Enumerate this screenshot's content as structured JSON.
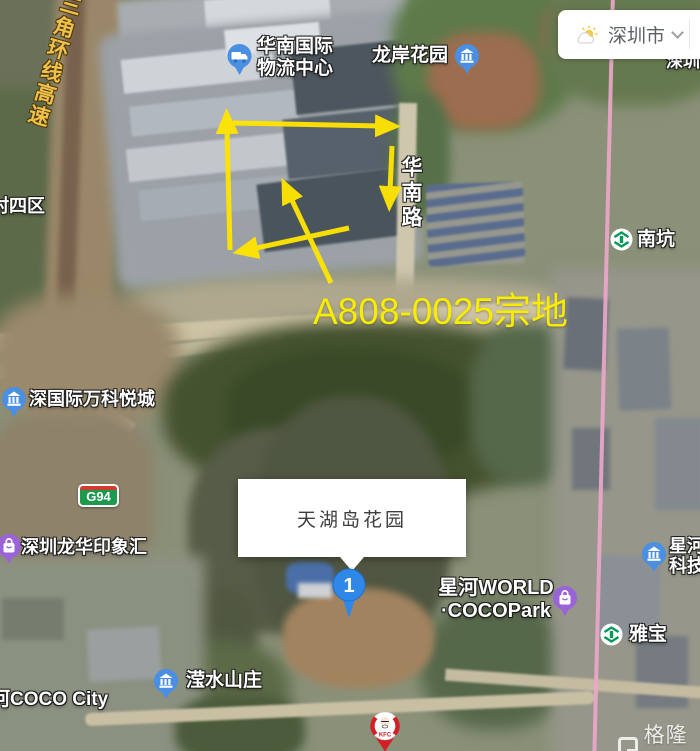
{
  "map": {
    "weather_widget": {
      "city": "深圳市",
      "icon": "sun-cloud-icon"
    },
    "annotation": {
      "parcel": "A808-0025宗地"
    },
    "roads": {
      "expressway": "三角环线高速",
      "huanan": "华南路",
      "g94": "G94"
    },
    "pois": {
      "logistics_line1": "华南国际",
      "logistics_line2": "物流中心",
      "longan": "龙岸花园",
      "cunsiqu": "村四区",
      "nankeng": "南坑",
      "shenzhen_partial": "深圳",
      "wanke": "深国际万科悦城",
      "yinxianghui": "深圳龙华印象汇",
      "xinghe_line1": "星河WORLD",
      "xinghe_line2": "·COCOPark",
      "yabao": "雅宝",
      "yingshui": "滢水山庄",
      "cococity": "河COCO City",
      "xinghe_partial1": "星河",
      "xinghe_partial2": "科技",
      "kfc": "KFC"
    },
    "infobox": {
      "title": "天湖岛花园",
      "marker_number": "1"
    },
    "watermark": {
      "logo_letter": "G",
      "text": "格隆汇"
    },
    "colors": {
      "annotation_yellow": "#ffe400",
      "parcel_yellow": "#f8ec00",
      "road_label_gold": "#f0c14a",
      "metro_green": "#009a57",
      "pin_blue": "#4a8fe2",
      "pin_purple": "#9a63d8",
      "metro_line_pink": "#eda7cb",
      "kfc_red": "#d22027",
      "g94_green": "#1d9a4e"
    }
  }
}
